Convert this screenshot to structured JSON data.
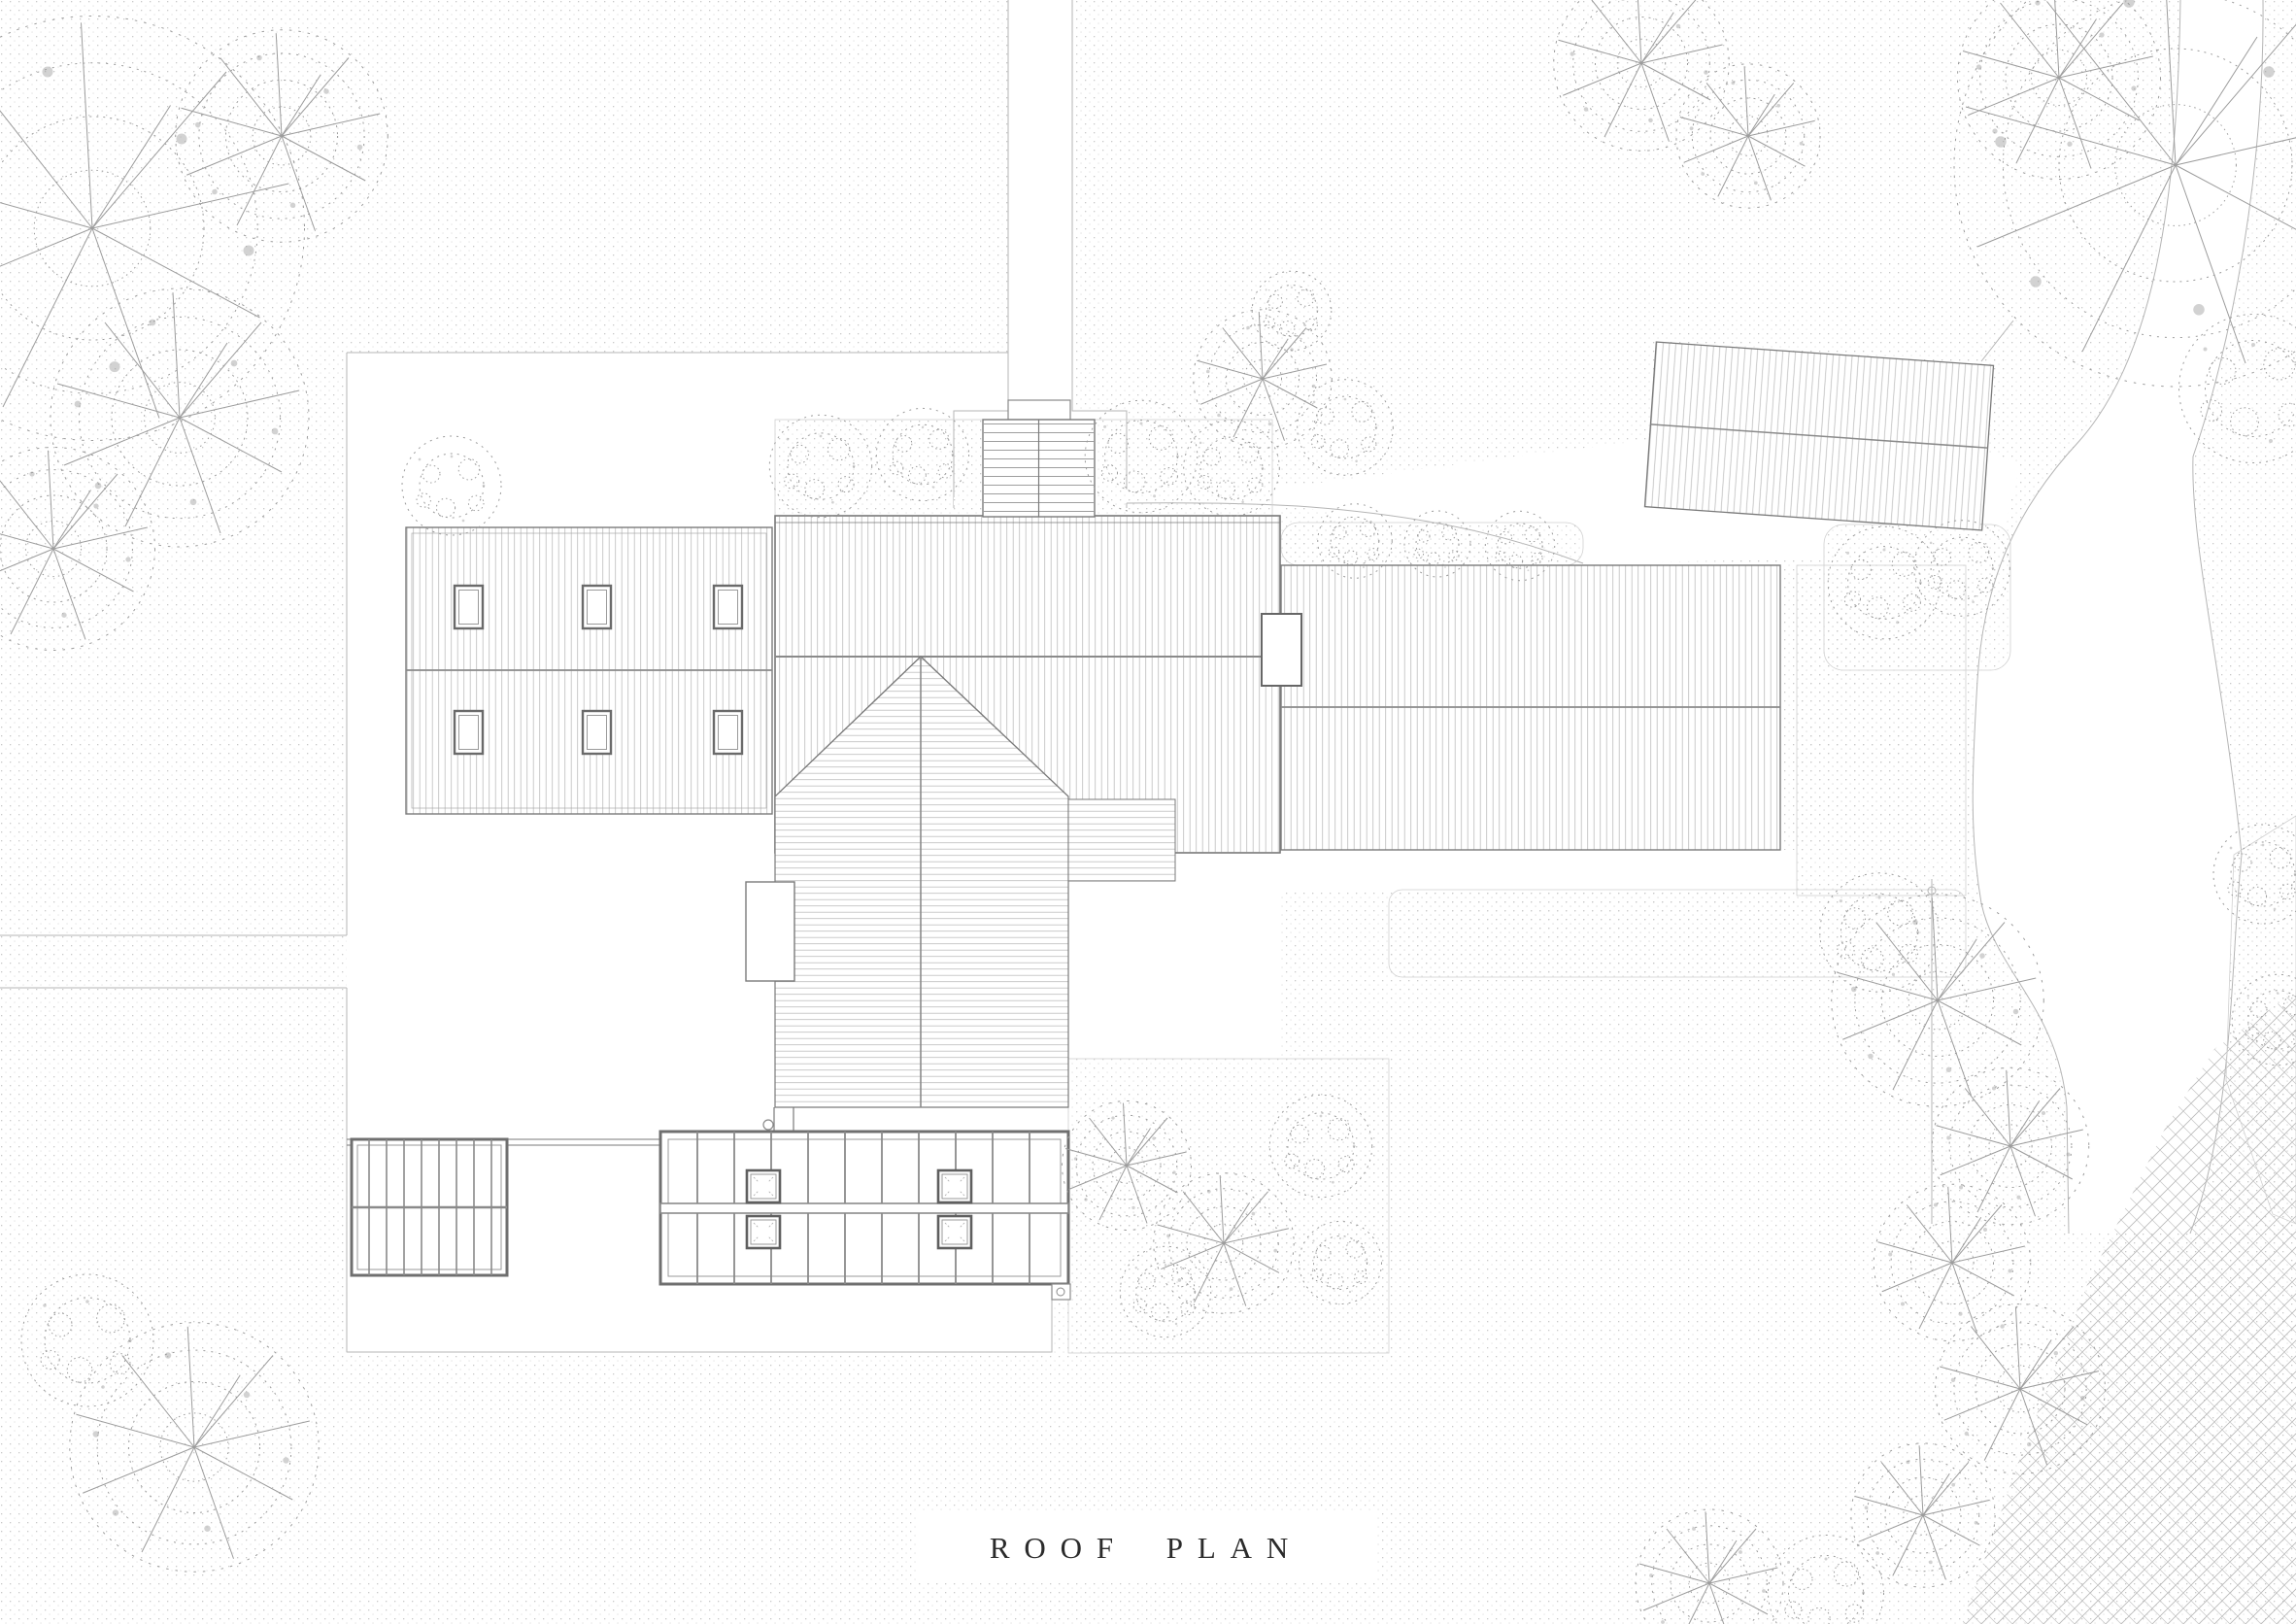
{
  "title_block": {
    "label": "ROOF PLAN"
  },
  "drawing": {
    "kind": "architectural roof / site plan",
    "buildings": [
      "left-wing-roof",
      "main-roof",
      "south-gable-roof",
      "right-wing-roof",
      "garage-roof",
      "chimney",
      "conservatory-roof",
      "pergola-roof"
    ],
    "landscape": [
      "driveway",
      "access-road",
      "garden-path",
      "hedge",
      "trees",
      "shrubs",
      "river-bank"
    ]
  },
  "colors": {
    "paper": "#ffffff",
    "line": "#7a7a7a",
    "line-light": "#b5b5b5",
    "hatch": "#bdbdbd",
    "stipple": "#c9c9c9",
    "foliage": "#9c9c9c",
    "text": "#2b2b2b"
  }
}
